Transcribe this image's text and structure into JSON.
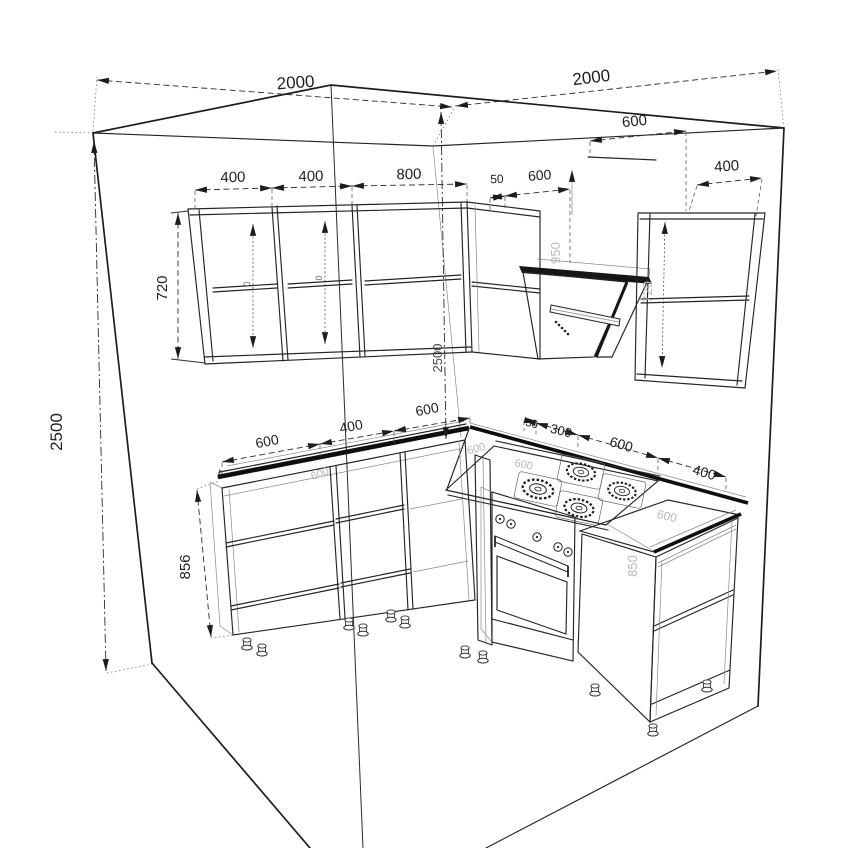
{
  "drawing": {
    "kind": "kitchen corner cabinet technical drawing, isometric wireframe",
    "background_color": "#ffffff",
    "line_color": "#242424",
    "dim_text_color": "#1f1f1f",
    "faint_text_color": "#b8b8b8",
    "walls": {
      "left_wall_width_mm": "2000",
      "right_wall_width_mm": "2000",
      "wall_height_mm": "2500"
    },
    "upper_cabinets": {
      "left_run_widths_mm": [
        "400",
        "400",
        "800"
      ],
      "corner_gap_mm": "50",
      "corner_cabinet_width_mm": "600",
      "hood_width_mm": "600",
      "right_cabinet_width_mm": "400",
      "cabinet_height_mm": "720",
      "hood_bottom_height_mm": "950",
      "right_cabinet_height_mm": "720"
    },
    "base_cabinets": {
      "left_run_widths_mm": [
        "600",
        "400",
        "600"
      ],
      "right_run_widths_mm": [
        "50",
        "300",
        "600",
        "400"
      ],
      "counter_height_mm": "856",
      "right_cabinet_height_mm": "850",
      "counter_depth_mm": "600"
    }
  },
  "labels": {
    "wall_left_width": "2000",
    "wall_right_width": "2000",
    "wall_height": "2500",
    "corner_height": "2500",
    "upper_height": "720",
    "upper_l1": "400",
    "upper_l2": "400",
    "upper_l3": "800",
    "gap_corner": "50",
    "upper_corner": "600",
    "hood_width": "600",
    "upper_right": "400",
    "counter_l1": "600",
    "counter_l2": "400",
    "counter_l3": "600",
    "right_gap": "50",
    "right_filler": "300",
    "stove_width": "600",
    "base_right": "400",
    "base_height": "856",
    "hood_height_faint": "950",
    "upper_right_height_faint": "720",
    "base_right_height_faint": "850",
    "depth_faint_1": "600",
    "depth_faint_2": "600",
    "depth_faint_3": "600",
    "depth_faint_4": "600",
    "shelf_mark_1": "0",
    "shelf_mark_2": "0"
  }
}
